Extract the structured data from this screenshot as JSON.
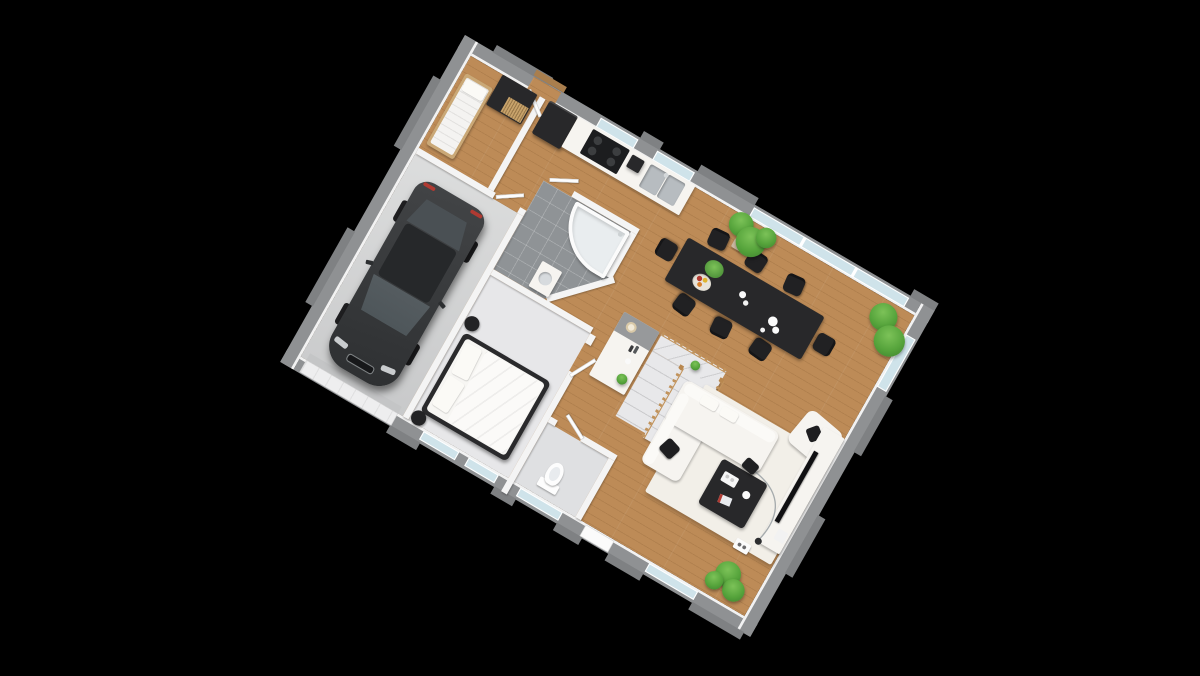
{
  "scene": {
    "title": "3D isometric ground-floor plan with garage",
    "projection": "isometric",
    "background": "#000000"
  },
  "colors": {
    "background": "#000000",
    "wood_floor": "#bd8b57",
    "wall_exterior": "#8f9193",
    "wall_exterior_dark": "#7f8183",
    "wall_interior": "#f4f4f4",
    "garage_floor": "#d2d3d4",
    "bath_tile": "#8f9396",
    "carpet": "#e7e7e9",
    "wc_floor": "#dfe0e2",
    "stair_tread": "#e8e8ea",
    "rail_wood": "#c1935c",
    "glass": "#cfe3ea",
    "furniture_white": "#f6f4f0",
    "rug": "#f2efe8",
    "furniture_dark": "#28282a",
    "car_body": "#3a3c3e",
    "car_glass": "#4e565a",
    "plant_green": "#55a33b",
    "plant_green_dark": "#3b7e2d",
    "plant_green_light": "#7cc258",
    "pot_beige": "#cbb9a2",
    "accent_red": "#b03a32"
  },
  "rooms": [
    {
      "id": "garage",
      "name": "Garage"
    },
    {
      "id": "storage",
      "name": "Storage room"
    },
    {
      "id": "bathroom",
      "name": "Bathroom"
    },
    {
      "id": "bedroom",
      "name": "Bedroom"
    },
    {
      "id": "wc",
      "name": "WC"
    },
    {
      "id": "kitchen",
      "name": "Kitchen"
    },
    {
      "id": "dining",
      "name": "Dining area"
    },
    {
      "id": "living",
      "name": "Open living room"
    },
    {
      "id": "hall",
      "name": "Entry hall"
    },
    {
      "id": "stairs",
      "name": "Winder staircase"
    }
  ],
  "furniture": {
    "car": "Car",
    "single_bed": "Single bed",
    "wardrobe": "Wardrobe",
    "fridge": "Refrigerator",
    "cooktop": "Cooktop",
    "coffee_machine": "Coffee machine",
    "sink": "Double kitchen sink",
    "dining_table": "Dining table for 8",
    "chair": "Dining chair",
    "bathtub": "Corner bathtub",
    "vanity": "Washbasin",
    "double_bed": "Double bed",
    "nightstand": "Bedside stool",
    "toilet": "Toilet",
    "sideboard": "Sideboard",
    "staircase": "Winder staircase",
    "sofa": "Corner sofa",
    "armchair": "Armchair",
    "coffee_table": "Coffee table",
    "tv_stand": "TV stand",
    "tv": "Television",
    "floor_lamp": "Arc floor lamp",
    "rug": "Area rug",
    "plant": "Potted plant",
    "garage_door": "Garage door",
    "front_door": "Front door",
    "back_door": "Back door",
    "window": "Window"
  }
}
